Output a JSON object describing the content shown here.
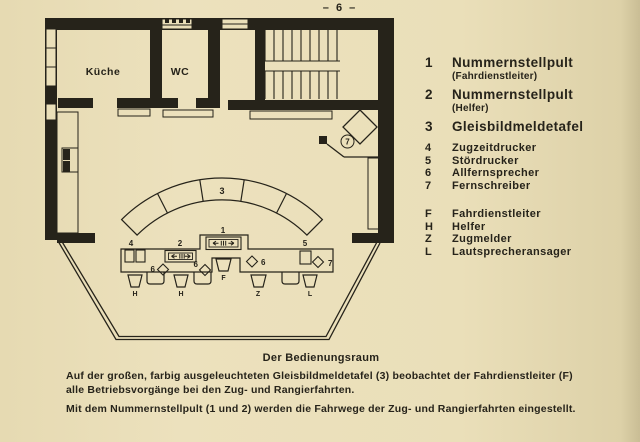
{
  "page": {
    "number": "– 6 –",
    "paper_color": "#eadfb9",
    "ink_color": "#26231a"
  },
  "plan": {
    "rooms": {
      "kitchen": "Küche",
      "wc": "WC"
    },
    "labels": {
      "panel3": "3",
      "console1": "1",
      "console2": "2",
      "printer4": "4",
      "printer5": "5",
      "phone6_left": "6",
      "phone6_mid": "6",
      "phone6_right": "6",
      "teleprinter7_desk": "7",
      "teleprinter7_corner": "7",
      "seat_h1": "H",
      "seat_h2": "H",
      "seat_f": "F",
      "seat_z": "Z",
      "seat_l": "L"
    }
  },
  "legend": {
    "numbered_large": [
      {
        "key": "1",
        "label": "Nummernstellpult",
        "sub": "(Fahrdienstleiter)"
      },
      {
        "key": "2",
        "label": "Nummernstellpult",
        "sub": "(Helfer)"
      },
      {
        "key": "3",
        "label": "Gleisbildmeldetafel",
        "sub": ""
      }
    ],
    "numbered_small": [
      {
        "key": "4",
        "label": "Zugzeitdrucker"
      },
      {
        "key": "5",
        "label": "Stördrucker"
      },
      {
        "key": "6",
        "label": "Allfernsprecher"
      },
      {
        "key": "7",
        "label": "Fernschreiber"
      }
    ],
    "lettered": [
      {
        "key": "F",
        "label": "Fahrdienstleiter"
      },
      {
        "key": "H",
        "label": "Helfer"
      },
      {
        "key": "Z",
        "label": "Zugmelder"
      },
      {
        "key": "L",
        "label": "Lautsprecheransager"
      }
    ]
  },
  "caption": {
    "title": "Der Bedienungsraum",
    "para1": "Auf der großen, farbig ausgeleuchteten Gleisbildmeldetafel (3) beobachtet der Fahrdienstleiter (F) alle Betriebsvorgänge bei den Zug- und Rangierfahrten.",
    "para2": "Mit dem Nummernstellpult (1 und 2) werden die Fahrwege der Zug- und Rangierfahrten eingestellt."
  }
}
